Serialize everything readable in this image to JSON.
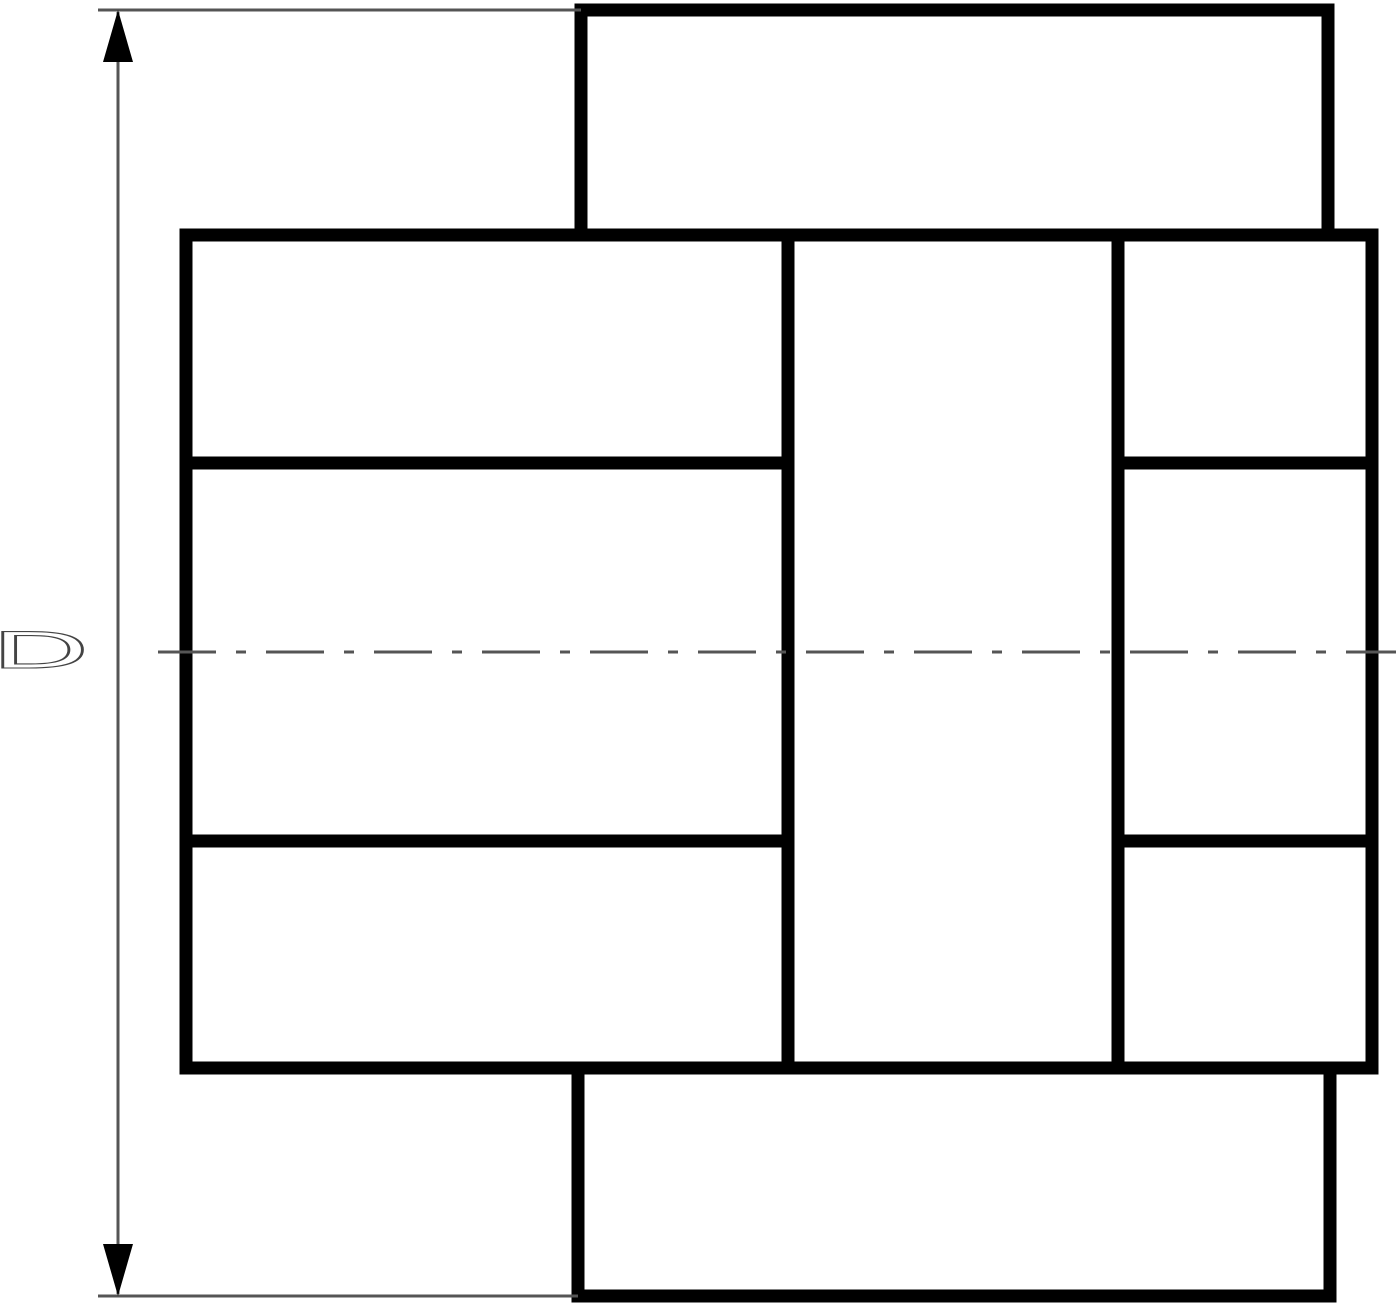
{
  "drawing": {
    "dimension": {
      "label": "D"
    },
    "colors": {
      "background": "#ffffff",
      "outline": "#000000",
      "thin_line": "#555555",
      "hatch_line": "#555555",
      "label_fill": "#ffffff",
      "label_stroke": "#444444"
    }
  }
}
